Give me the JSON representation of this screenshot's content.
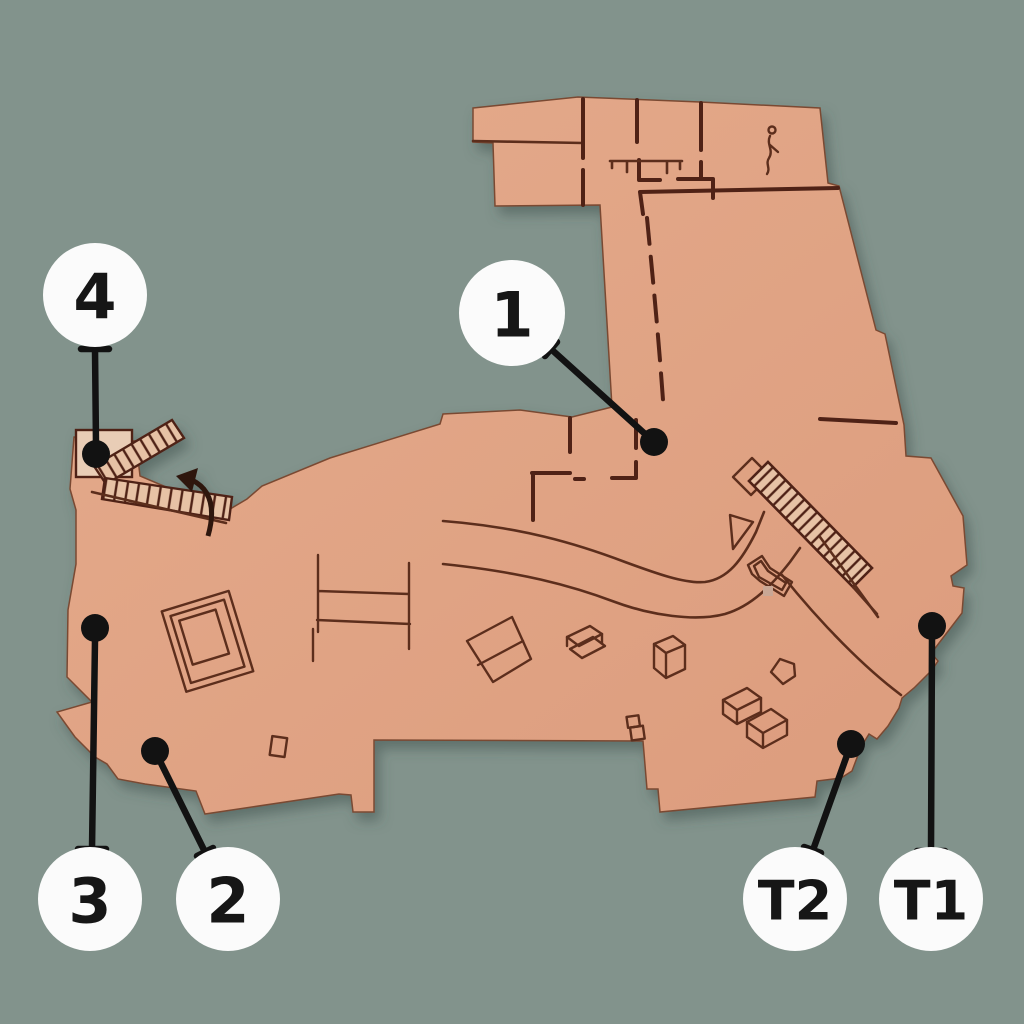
{
  "scene": {
    "description": "Photographed isometric floor plan (salmon cardboard model) on sage-green background with six circular location callouts connected by leader lines to black dots",
    "background_color": "#82938C",
    "floorplan_fill": "#E0A384",
    "floorplan_line_color": "#54281A",
    "stair_fill": "#E7C2A5",
    "marker_fill": "#FBFBFB",
    "marker_text_color": "#161616",
    "leader_color": "#121212"
  },
  "markers": [
    {
      "id": "1",
      "label": "1"
    },
    {
      "id": "2",
      "label": "2"
    },
    {
      "id": "3",
      "label": "3"
    },
    {
      "id": "4",
      "label": "4"
    },
    {
      "id": "T1",
      "label": "T1"
    },
    {
      "id": "T2",
      "label": "T2"
    }
  ],
  "floorplan_features": [
    "upper-wing-rooms",
    "tall-corridor",
    "curved-walkway",
    "zigzag-staircase-with-arrow",
    "large-diagonal-staircase",
    "reception-desk",
    "furniture-outlines",
    "person-figure"
  ]
}
